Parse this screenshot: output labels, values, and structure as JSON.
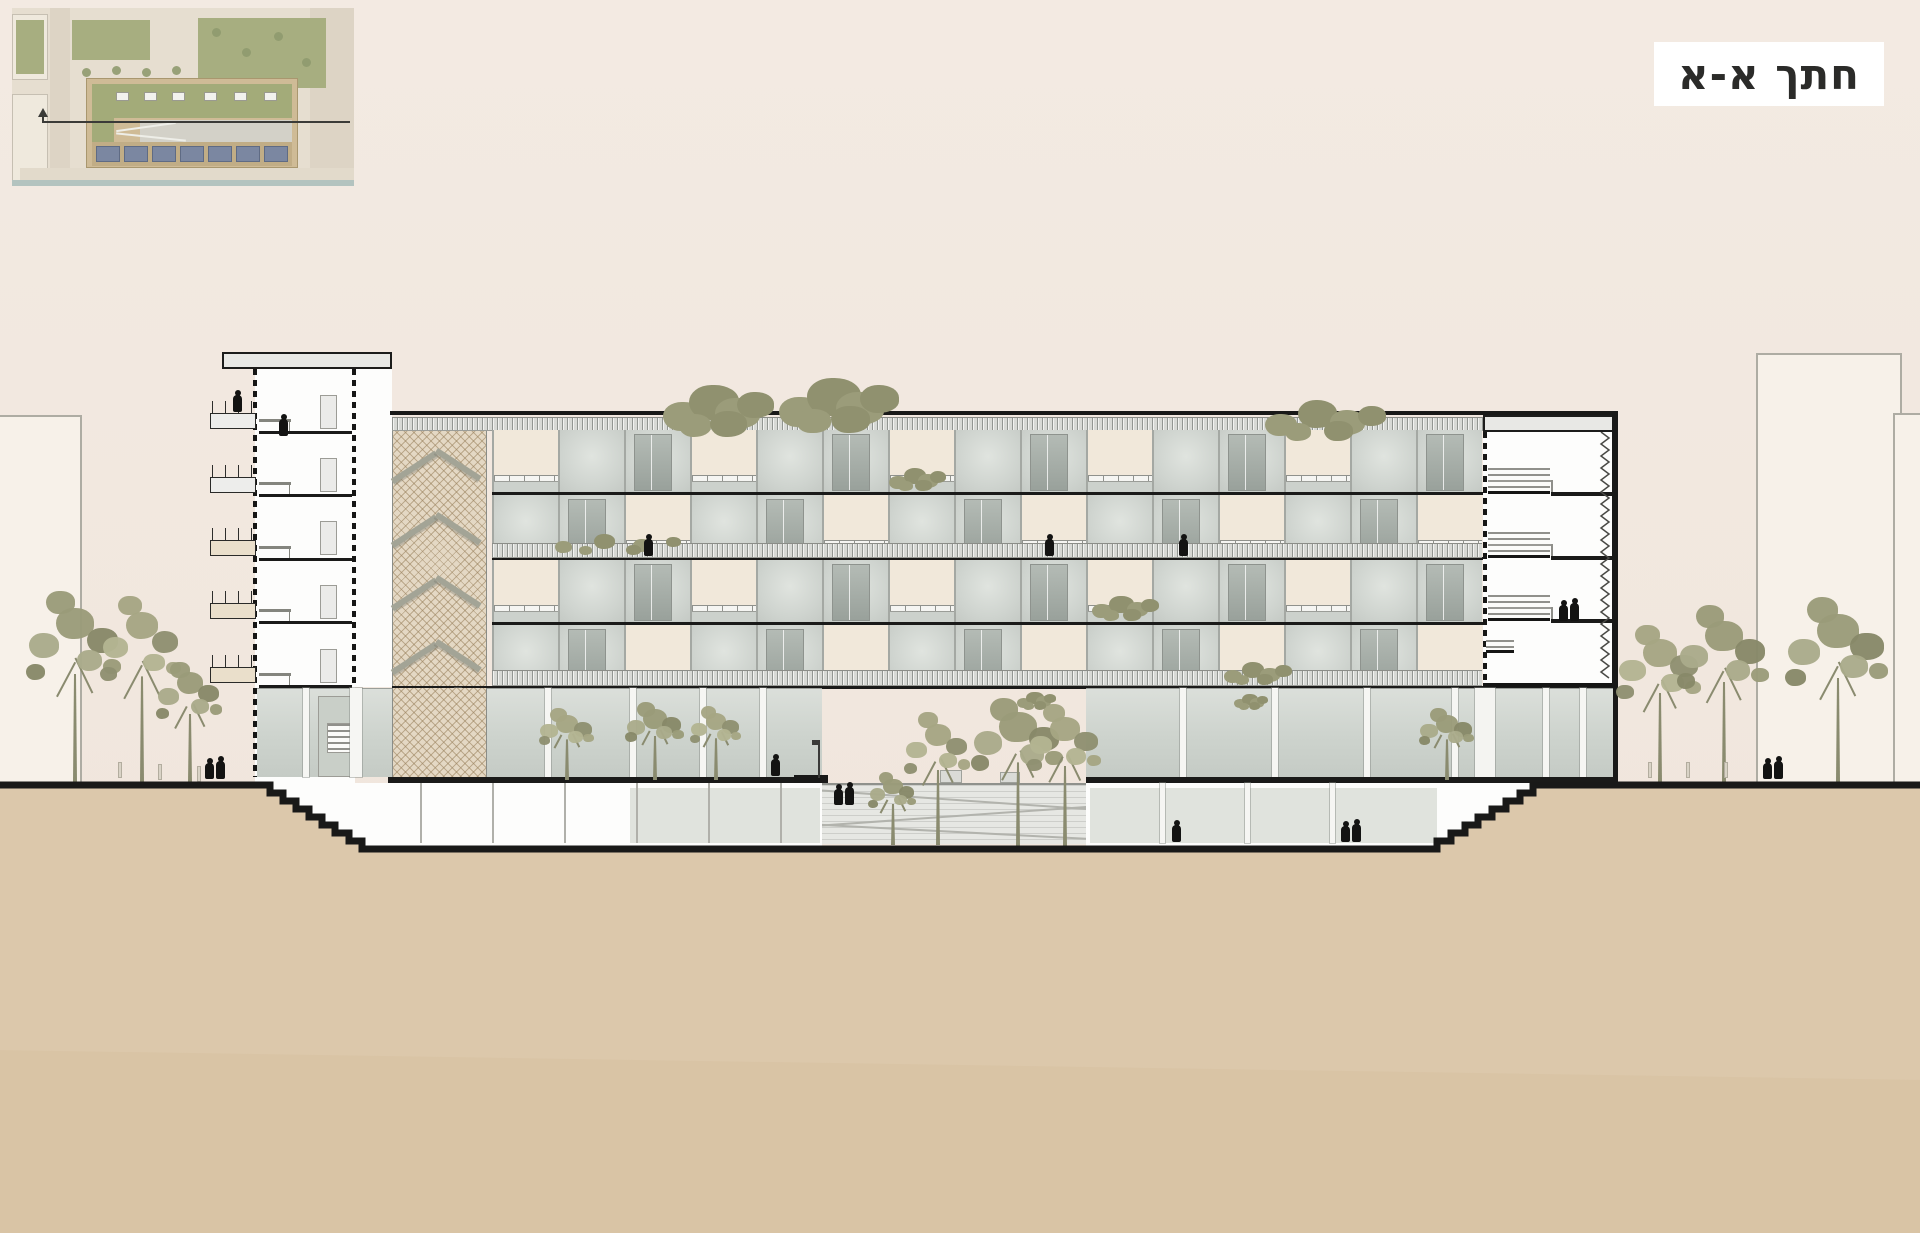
{
  "title": {
    "text": "חתך א-א",
    "meaning": "Section A-A"
  },
  "colors": {
    "sky": "#f2e8df",
    "earth": "#dcc8ab",
    "line": "#191918",
    "olive": "#9a9b79",
    "olive_light": "#aaab8a",
    "olive_dark": "#878868",
    "cream_panel": "#f1e8da",
    "glass": "#cfd4cf",
    "hatch": "#e4d8c4",
    "solar_panel": "#7b87a1",
    "plan_green": "#a7ae80",
    "canal": "#b3c3bf"
  },
  "facade": {
    "left": 492,
    "top": 430,
    "bay_width": 66,
    "floor_height": 65,
    "floors": 4,
    "bays": 15,
    "pattern": [
      "CGWCGWCGWCGWCGW",
      "GWCGWCGWCGWCGWC",
      "CGWCGWCGWCGWCGW",
      "GWCGWCGWCGWCGWC"
    ],
    "legend": {
      "C": "cream-balcony-panel",
      "G": "glass-panel",
      "W": "window-panel"
    }
  },
  "tower": {
    "slabs_y": [
      431,
      494,
      558,
      621,
      685
    ],
    "balconies_y": [
      413,
      477,
      540,
      603,
      667
    ],
    "doors_y": [
      395,
      458,
      521,
      585,
      649
    ]
  },
  "hatch_stair_levels": [
    [
      432,
      60
    ],
    [
      496,
      60
    ],
    [
      560,
      59
    ],
    [
      623,
      60
    ],
    [
      687,
      88
    ]
  ],
  "core_stairs": {
    "flights": [
      [
        1488,
        468
      ],
      [
        1488,
        532
      ],
      [
        1488,
        595
      ]
    ],
    "stubs_y": [
      492,
      556,
      619
    ],
    "people_landing_y": 622
  },
  "trees": [
    {
      "x": 75,
      "base": 782,
      "top": 585,
      "half": 52,
      "tone": "a"
    },
    {
      "x": 142,
      "base": 782,
      "top": 590,
      "half": 44,
      "tone": "b"
    },
    {
      "x": 190,
      "base": 782,
      "top": 658,
      "half": 36,
      "tone": "a"
    },
    {
      "x": 567,
      "base": 780,
      "top": 706,
      "half": 30,
      "tone": "b"
    },
    {
      "x": 655,
      "base": 780,
      "top": 700,
      "half": 32,
      "tone": "a"
    },
    {
      "x": 716,
      "base": 780,
      "top": 704,
      "half": 28,
      "tone": "b"
    },
    {
      "x": 893,
      "base": 845,
      "top": 770,
      "half": 26,
      "tone": "a"
    },
    {
      "x": 938,
      "base": 845,
      "top": 708,
      "half": 36,
      "tone": "b"
    },
    {
      "x": 1018,
      "base": 846,
      "top": 694,
      "half": 50,
      "tone": "a"
    },
    {
      "x": 1065,
      "base": 846,
      "top": 700,
      "half": 40,
      "tone": "b"
    },
    {
      "x": 1447,
      "base": 780,
      "top": 706,
      "half": 30,
      "tone": "a"
    },
    {
      "x": 1660,
      "base": 782,
      "top": 620,
      "half": 46,
      "tone": "b"
    },
    {
      "x": 1724,
      "base": 782,
      "top": 600,
      "half": 50,
      "tone": "a"
    },
    {
      "x": 1838,
      "base": 782,
      "top": 592,
      "half": 56,
      "tone": "a"
    }
  ],
  "shrubs": [
    {
      "x": 655,
      "y": 385,
      "w": 100,
      "h": 58
    },
    {
      "x": 770,
      "y": 378,
      "w": 110,
      "h": 62
    },
    {
      "x": 885,
      "y": 468,
      "w": 55,
      "h": 26
    },
    {
      "x": 543,
      "y": 534,
      "w": 150,
      "h": 24
    },
    {
      "x": 1087,
      "y": 596,
      "w": 66,
      "h": 28
    },
    {
      "x": 1218,
      "y": 662,
      "w": 70,
      "h": 26
    },
    {
      "x": 1255,
      "y": 400,
      "w": 125,
      "h": 46
    },
    {
      "x": 1014,
      "y": 692,
      "w": 36,
      "h": 20
    },
    {
      "x": 1232,
      "y": 694,
      "w": 30,
      "h": 18
    }
  ],
  "people": [
    {
      "x": 237,
      "feet": 413,
      "kind": "single"
    },
    {
      "x": 283,
      "feet": 437,
      "kind": "single"
    },
    {
      "x": 648,
      "feet": 557,
      "kind": "single"
    },
    {
      "x": 1049,
      "feet": 557,
      "kind": "single"
    },
    {
      "x": 1183,
      "feet": 557,
      "kind": "single"
    },
    {
      "x": 1568,
      "feet": 622,
      "kind": "pair"
    },
    {
      "x": 214,
      "feet": 780,
      "kind": "pair"
    },
    {
      "x": 775,
      "feet": 777,
      "kind": "single"
    },
    {
      "x": 843,
      "feet": 806,
      "kind": "pair"
    },
    {
      "x": 1176,
      "feet": 843,
      "kind": "single"
    },
    {
      "x": 1350,
      "feet": 843,
      "kind": "pair"
    },
    {
      "x": 1772,
      "feet": 780,
      "kind": "pair"
    }
  ],
  "bollards": [
    {
      "x": 118,
      "y": 762
    },
    {
      "x": 158,
      "y": 764
    },
    {
      "x": 197,
      "y": 766
    },
    {
      "x": 1648,
      "y": 762
    },
    {
      "x": 1686,
      "y": 762
    },
    {
      "x": 1724,
      "y": 762
    }
  ],
  "ground": {
    "street_y": 778,
    "basement_floor_y": 843,
    "left_steps": {
      "from_x": 257,
      "to_x": 362
    },
    "right_steps": {
      "from_x": 1437,
      "to_x": 1547
    }
  },
  "site_plan": {
    "has_section_line": true,
    "solar_panels": 7,
    "skylights": 6
  }
}
